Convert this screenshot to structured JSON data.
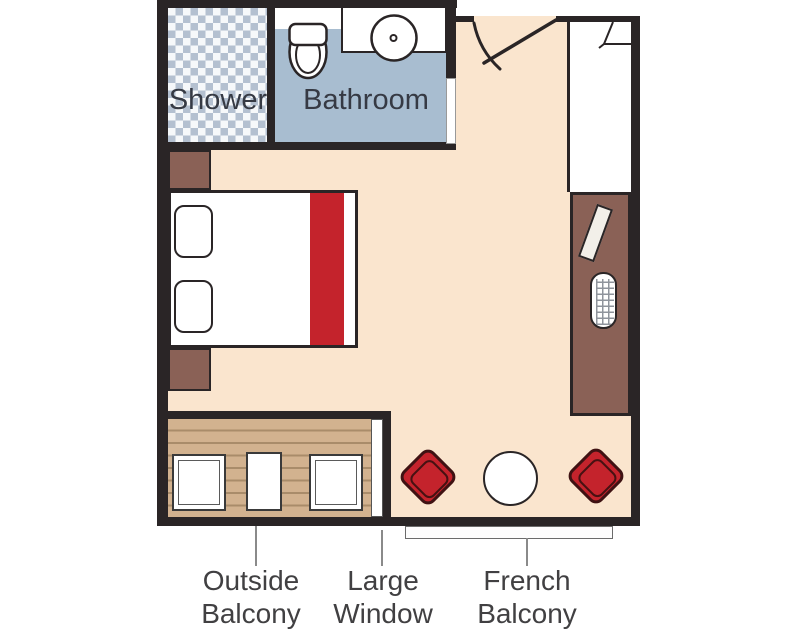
{
  "figure": {
    "type": "cabin-floor-plan",
    "room_labels": {
      "shower": "Shower",
      "bathroom": "Bathroom"
    },
    "callouts": {
      "outside_balcony": {
        "line1": "Outside",
        "line2": "Balcony"
      },
      "large_window": {
        "line1": "Large",
        "line2": "Window"
      },
      "french_balcony": {
        "line1": "French",
        "line2": "Balcony"
      }
    }
  },
  "theme": {
    "wall": "#2a2526",
    "floor": "#fae5ce",
    "furniture-brown": "#8a6156",
    "bathroom-blue": "#a8bdd0",
    "checker-blue": "#b4c0d0",
    "checker-white": "#f6f8fa",
    "accent-red": "#c4232c",
    "accent-red-dark": "#3f1213",
    "wood": "#d2b28f",
    "wood-line": "#a98c6a",
    "room-text": "#363a44",
    "callout-text": "#414042",
    "leader-gray": "#8a8a8a"
  }
}
